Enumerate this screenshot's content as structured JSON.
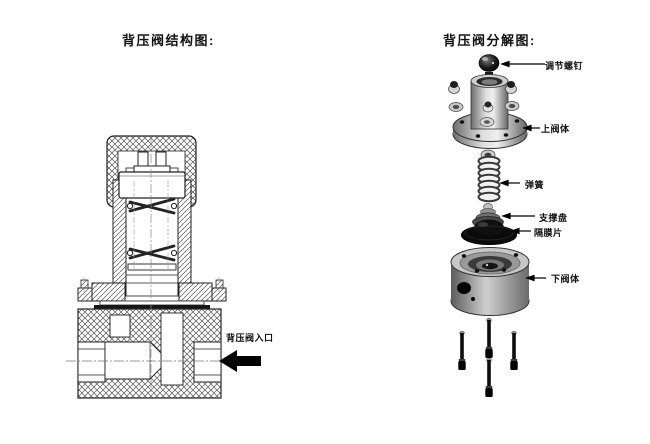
{
  "page": {
    "background": "#ffffff"
  },
  "left_panel": {
    "title": "背压阀结构图:",
    "inlet_label": "背压阀入口"
  },
  "right_panel": {
    "title": "背压阀分解图:",
    "parts": [
      {
        "id": "adjusting-screw",
        "label": "调节螺钉"
      },
      {
        "id": "upper-valve-body",
        "label": "上阀体"
      },
      {
        "id": "spring",
        "label": "弹簧"
      },
      {
        "id": "support-plate",
        "label": "支撑盘"
      },
      {
        "id": "diaphragm",
        "label": "隔膜片"
      },
      {
        "id": "lower-valve-body",
        "label": "下阀体"
      }
    ]
  },
  "icons": [
    {
      "name": "inlet-arrow-icon",
      "meaning": "flow direction into valve, pointing left"
    },
    {
      "name": "leader-arrow-icon",
      "meaning": "label pointer to part"
    }
  ],
  "colors": {
    "line": "#222222",
    "metal_light": "#e8e8e8",
    "metal_dark": "#6a6a6a",
    "black_part": "#0b0b0b",
    "arrow": "#000000"
  }
}
